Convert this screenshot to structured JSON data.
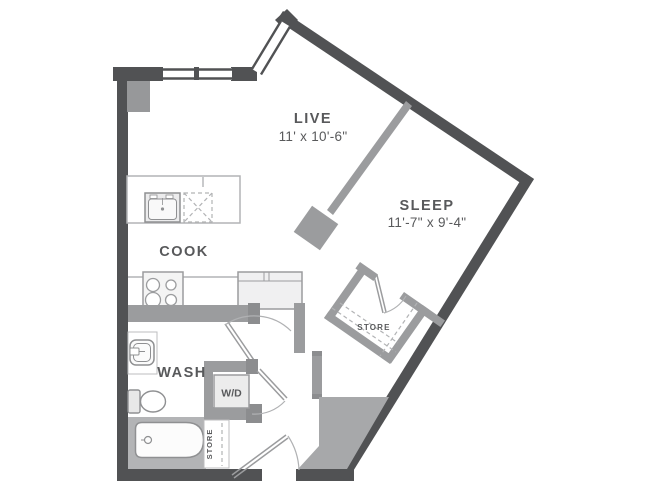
{
  "plan": {
    "rooms": {
      "live": {
        "name": "LIVE",
        "dims": "11' x 10'-6\""
      },
      "sleep": {
        "name": "SLEEP",
        "dims": "11'-7\" x 9'-4\""
      },
      "cook": {
        "name": "COOK"
      },
      "wash": {
        "name": "WASH"
      }
    },
    "closets": {
      "wd": {
        "label": "W/D"
      },
      "store_bedroom": {
        "label": "STORE"
      },
      "store_hall": {
        "label": "STORE"
      }
    },
    "colors": {
      "wall_dark": "#515254",
      "wall_light": "#9b9c9e",
      "fixture_outline": "#8f9092",
      "label_text": "#58595b",
      "shaft_fill": "#a7a8aa",
      "tub_surround": "#b3b4b6",
      "background": "#ffffff"
    }
  }
}
